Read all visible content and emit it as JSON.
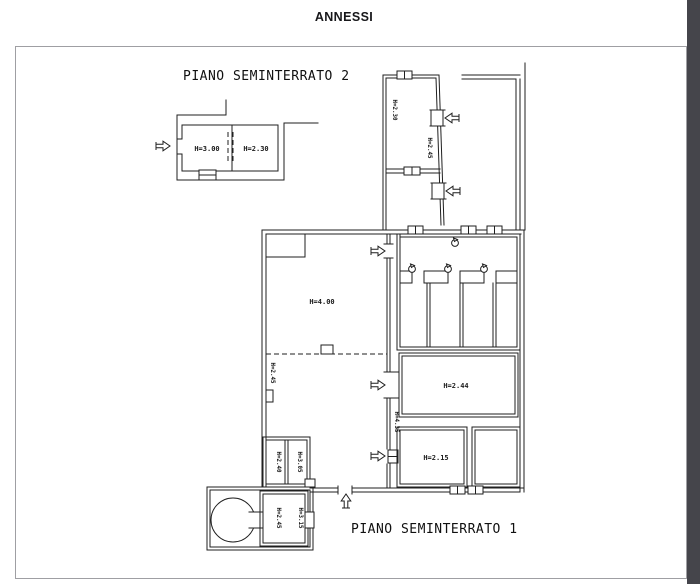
{
  "page": {
    "title": "ANNESSI"
  },
  "plan2": {
    "title": "PIANO SEMINTERRATO 2",
    "room_labels": {
      "room1": "H=3.00",
      "room2": "H=2.30"
    }
  },
  "plan1": {
    "title": "PIANO SEMINTERRATO 1",
    "room_labels": {
      "top_room_upper": "H=2.30",
      "top_room_lower": "H=2.45",
      "main_hall": "H=4.00",
      "left_wall": "H=2.45",
      "shaft": "H=4.35",
      "room_244": "H=2.44",
      "room_215": "H=2.15",
      "small_room_left": "H=2.40",
      "small_room_right": "H=3.05",
      "cellar_room_left": "H=2.45",
      "cellar_room_right": "H=3.15"
    }
  },
  "icons": {
    "entrance_arrows": "direction-arrow",
    "window_symbol": "window-threshold",
    "fixture_symbol": "ceiling-fixture",
    "cistern": "circular-cistern"
  },
  "colors": {
    "line": "#1f1f1f",
    "page_border": "#9f9fa3",
    "edge_strip": "#45454b",
    "background": "#ffffff"
  }
}
